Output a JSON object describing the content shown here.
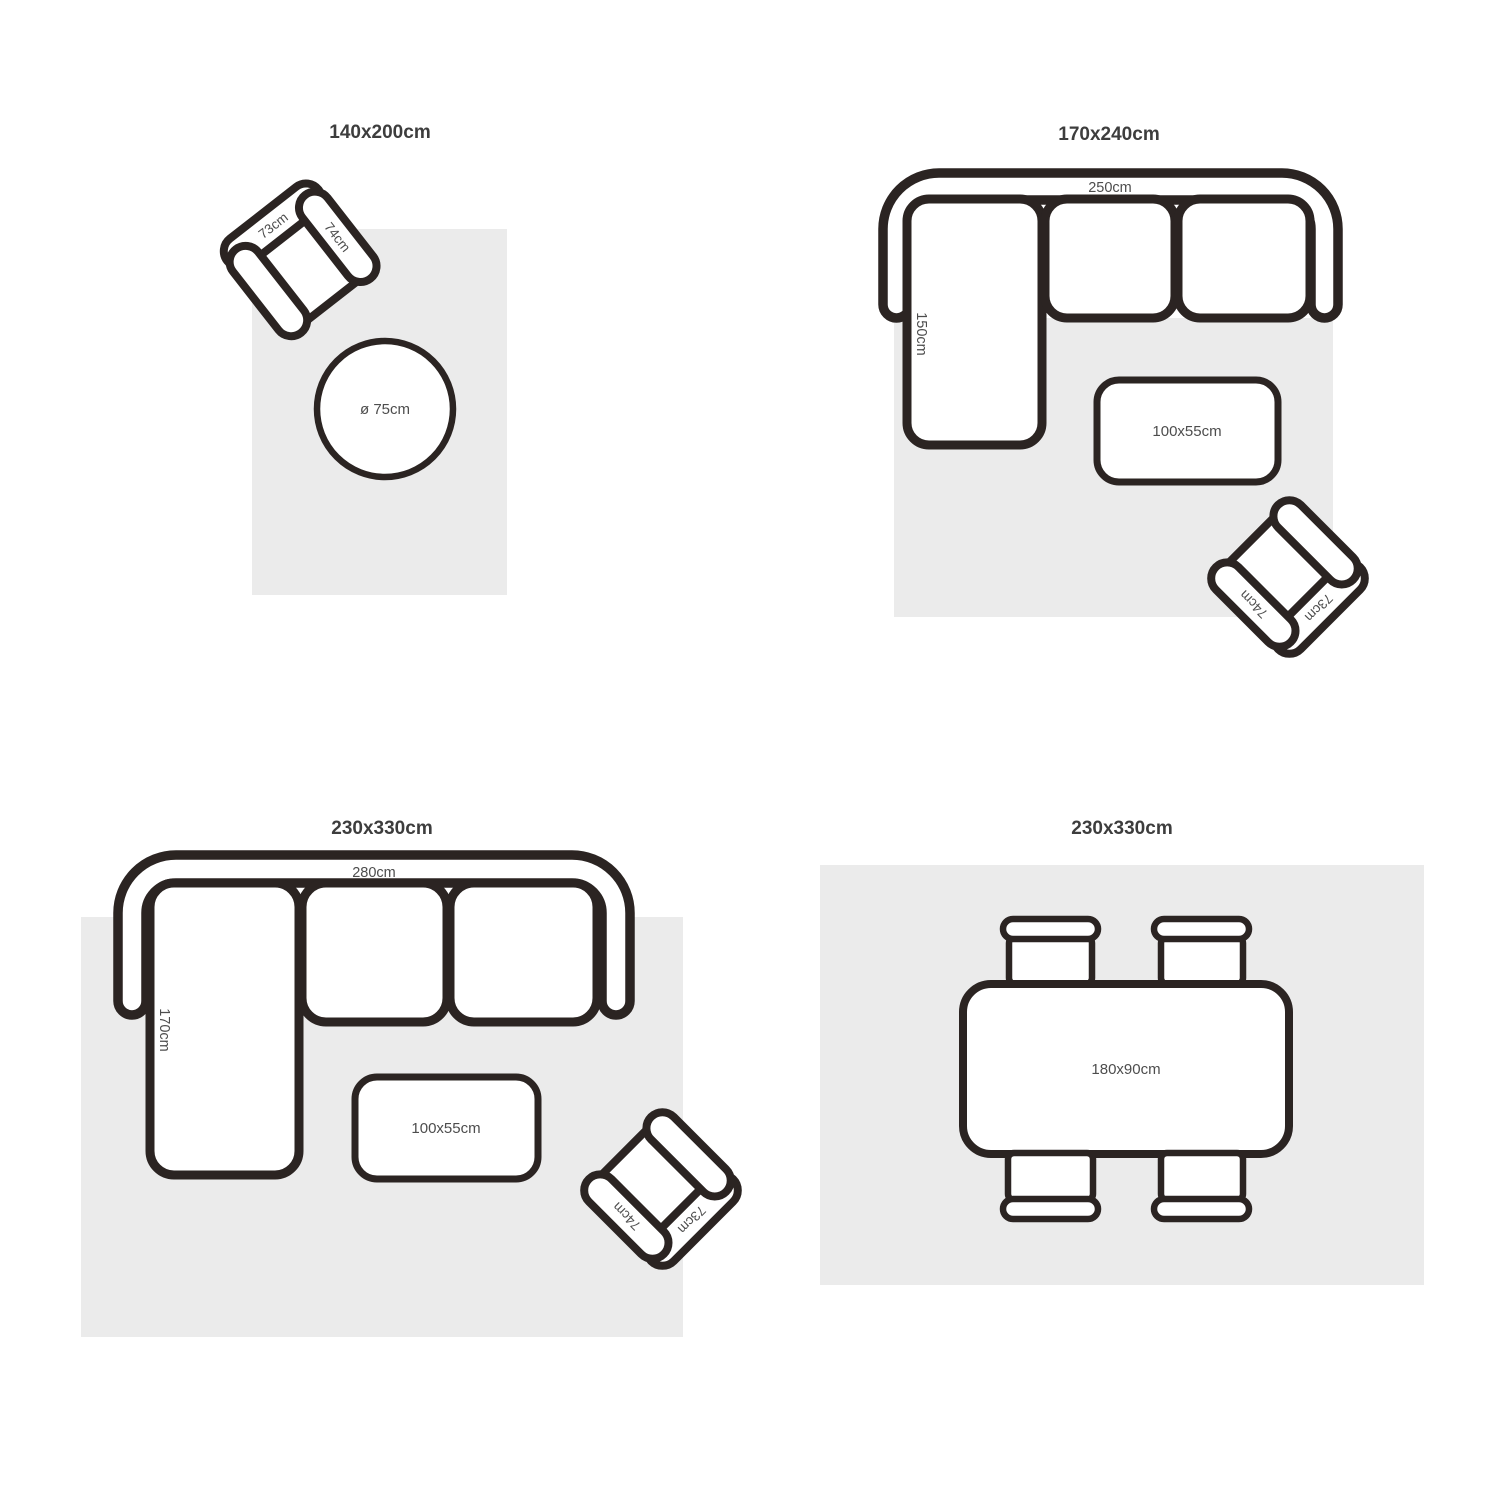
{
  "colors": {
    "outline": "#2b2422",
    "rug_fill": "#ebebeb",
    "furniture_fill": "#ffffff",
    "title_text": "#3d3d3d",
    "label_text": "#4d4d4d",
    "background": "#ffffff"
  },
  "quadrants": [
    {
      "title": "140x200cm",
      "armchair": {
        "back_label": "73cm",
        "arm_label": "74cm"
      },
      "round_table": {
        "label": "ø 75cm"
      }
    },
    {
      "title": "170x240cm",
      "sofa": {
        "width_label": "250cm",
        "depth_label": "150cm"
      },
      "coffee_table": {
        "label": "100x55cm"
      },
      "armchair": {
        "back_label": "73cm",
        "arm_label": "74cm"
      }
    },
    {
      "title": "230x330cm",
      "sofa": {
        "width_label": "280cm",
        "depth_label": "170cm"
      },
      "coffee_table": {
        "label": "100x55cm"
      },
      "armchair": {
        "back_label": "73cm",
        "arm_label": "74cm"
      }
    },
    {
      "title": "230x330cm",
      "dining_table": {
        "label": "180x90cm"
      }
    }
  ]
}
